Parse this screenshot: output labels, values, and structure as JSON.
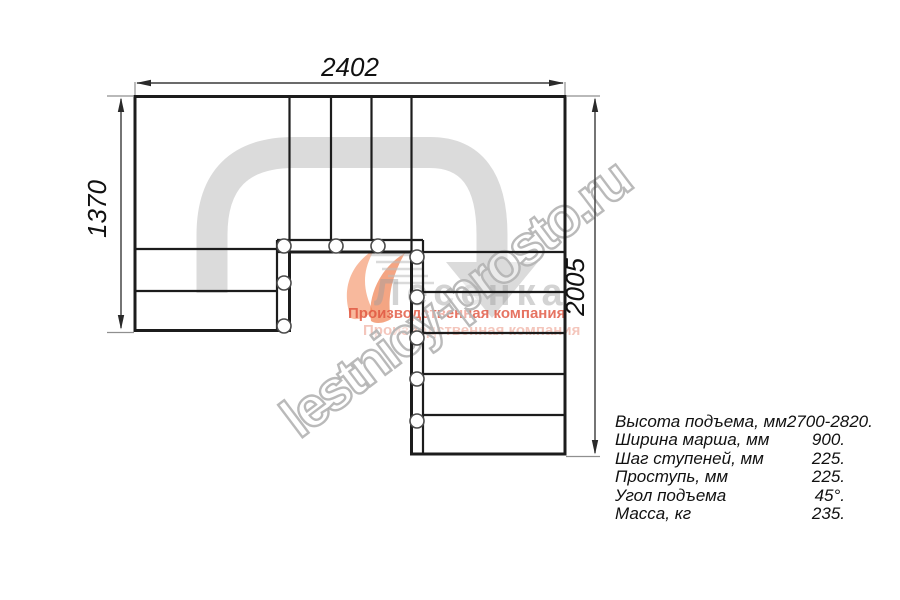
{
  "diagram": {
    "title": "staircase-plan-view",
    "dimensions": {
      "top_width_mm": "2402",
      "left_height_mm": "1370",
      "right_height_mm": "2005"
    },
    "colors": {
      "walkline": "#dbdbdb",
      "drawing_line": "#1c1c1c",
      "dimension_line": "#3a3a3a",
      "extension_line": "#8f8f8f"
    }
  },
  "specs": {
    "rows": [
      {
        "label": "Высота подъема, мм",
        "value": "2700-2820."
      },
      {
        "label": "Ширина марша, мм",
        "value": "900."
      },
      {
        "label": "Шаг ступеней, мм",
        "value": "225."
      },
      {
        "label": "Проступь, мм",
        "value": "225."
      },
      {
        "label": "Угол подъема",
        "value": "45°."
      },
      {
        "label": "Масса, кг",
        "value": "235."
      }
    ]
  },
  "watermark": {
    "text": "lestnicy-prosto.ru"
  },
  "logo": {
    "name": "Лесенка",
    "tagline": "Производственная компания",
    "tagline_echo": "Производственная компания",
    "orange": "#ef7f4e",
    "red": "#e0523c"
  }
}
